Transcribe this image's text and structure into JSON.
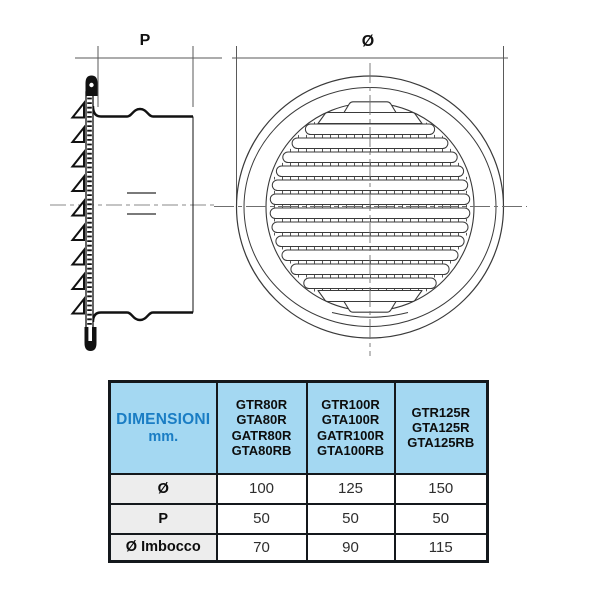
{
  "drawing": {
    "side_view": {
      "dimension_label": "P"
    },
    "front_view": {
      "dimension_label": "Ø"
    }
  },
  "table": {
    "dim_header": {
      "line1": "DIMENSIONI",
      "line2": "mm."
    },
    "model_columns": [
      "GTR80R\nGTA80R\nGATR80R\nGTA80RB",
      "GTR100R\nGTA100R\nGATR100R\nGTA100RB",
      "GTR125R\nGTA125R\nGTA125RB"
    ],
    "rows": [
      {
        "label": "Ø",
        "values": [
          "100",
          "125",
          "150"
        ]
      },
      {
        "label": "P",
        "values": [
          "50",
          "50",
          "50"
        ]
      },
      {
        "label": "Ø Imbocco",
        "values": [
          "70",
          "90",
          "115"
        ]
      }
    ]
  },
  "colors": {
    "header_bg": "#a4d8f2",
    "header_text_blue": "#1a7dc4",
    "label_cell_bg": "#ededed",
    "table_border": "#14181c",
    "drawing_line": "#111111",
    "centerline_gray": "#8a8a8a"
  }
}
